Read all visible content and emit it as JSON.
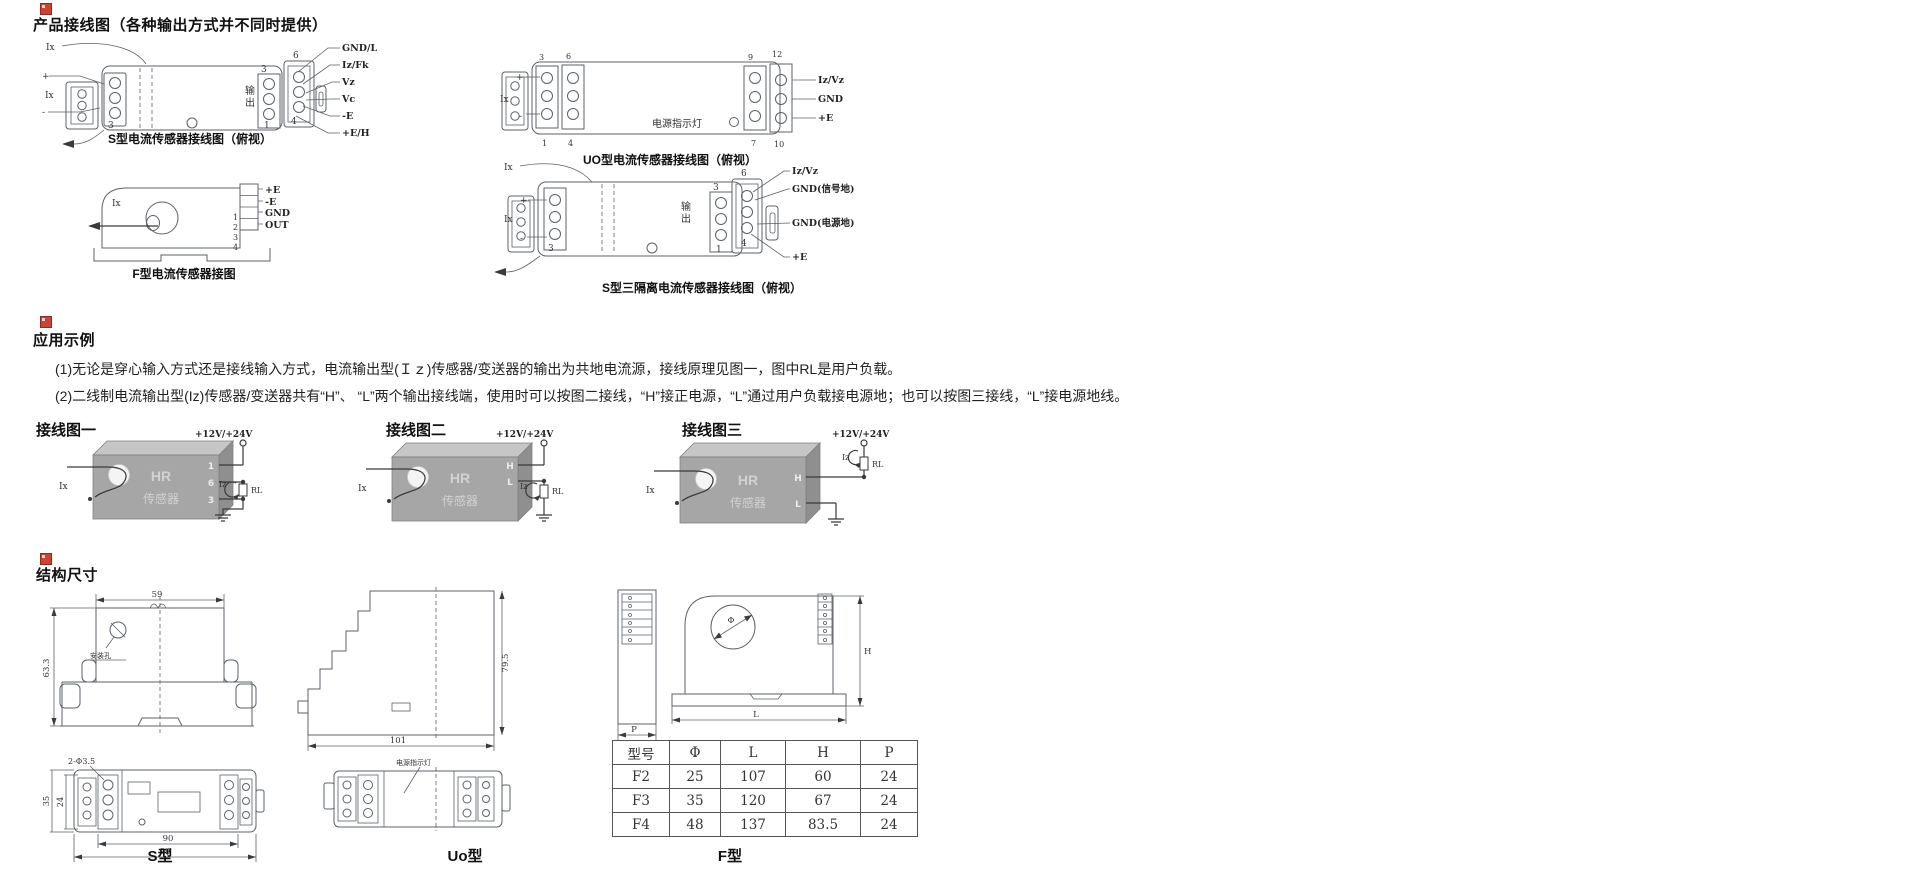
{
  "s1": {
    "title": "产品接线图（各种输出方式并不同时提供）",
    "a": {
      "caption": "S型电流传感器接线图（俯视）",
      "ix1": "Ix",
      "ix2": "Ix",
      "plus": "+",
      "minus": "-",
      "out1": "输",
      "out2": "出",
      "nl3": "3",
      "nr3": "3",
      "nr1": "1",
      "nr6": "6",
      "nr4": "4",
      "labels": [
        "GND/L",
        "Iz/Fk",
        "Vz",
        "Vc",
        "-E",
        "+E/H"
      ]
    },
    "b": {
      "caption": "F型电流传感器接图",
      "ix": "Ix",
      "pins": [
        "+E",
        "-E",
        "GND",
        "OUT"
      ],
      "nums": [
        "1",
        "2",
        "3",
        "4"
      ]
    },
    "c": {
      "caption": "UO型电流传感器接线图（俯视）",
      "ix": "Ix",
      "plus": "+",
      "minus": "-",
      "led": "电源指示灯",
      "n3": "3",
      "n1": "1",
      "n6": "6",
      "n4": "4",
      "n9": "9",
      "n7": "7",
      "n12": "12",
      "n10": "10",
      "labels": [
        "Iz/Vz",
        "GND",
        "+E"
      ]
    },
    "d": {
      "caption": "S型三隔离电流传感器接线图（俯视）",
      "ix1": "Ix",
      "ix2": "Ix",
      "plus": "+",
      "minus": "-",
      "out1": "输",
      "out2": "出",
      "nl3": "3",
      "nr3": "3",
      "nr1": "1",
      "nr6": "6",
      "nr4": "4",
      "labels": [
        "Iz/Vz",
        "GND(信号地)",
        "GND(电源地)",
        "+E"
      ]
    }
  },
  "s2": {
    "title": "应用示例",
    "p1": "(1)无论是穿心输入方式还是接线输入方式，电流输出型(Ｉｚ)传感器/变送器的输出为共地电流源，接线原理见图一，图中RL是用户负载。",
    "p2": "(2)二线制电流输出型(Iz)传感器/变送器共有“H”、 “L”两个输出接线端，使用时可以按图二接线，“H”接正电源，“L”通过用户负载接电源地；也可以按图三接线，“L”接电源地线。",
    "figs": [
      {
        "label": "接线图一",
        "supply": "+12V/+24V",
        "chip_line1": "HR",
        "chip_line2": "传感器",
        "ix": "Ix",
        "iz": "Iz",
        "rl": "RL",
        "t1": "1",
        "t2": "6",
        "t3": "3"
      },
      {
        "label": "接线图二",
        "supply": "+12V/+24V",
        "chip_line1": "HR",
        "chip_line2": "传感器",
        "ix": "Ix",
        "iz": "Iz",
        "rl": "RL",
        "t1": "H",
        "t2": "L"
      },
      {
        "label": "接线图三",
        "supply": "+12V/+24V",
        "chip_line1": "HR",
        "chip_line2": "传感器",
        "ix": "Ix",
        "iz": "Iz",
        "rl": "RL",
        "t1": "H",
        "t2": "L"
      }
    ]
  },
  "s3": {
    "title": "结构尺寸",
    "s": {
      "caption": "S型",
      "dim_top": "59",
      "dim_left": "63.3",
      "hole_label": "安装孔",
      "hole_dim": "2-Φ3.5",
      "dim_w_inner": "24",
      "dim_w_outer": "35",
      "dim_b_inner": "90",
      "dim_b_outer": "99"
    },
    "uo": {
      "caption": "Uo型",
      "dim_bottom": "101",
      "dim_right": "79.5",
      "led": "电源指示灯"
    },
    "f": {
      "caption": "F型",
      "p": "P",
      "phi": "Φ",
      "h": "H",
      "l": "L"
    },
    "table": {
      "headers": [
        "型号",
        "Φ",
        "L",
        "H",
        "P"
      ],
      "rows": [
        [
          "F2",
          "25",
          "107",
          "60",
          "24"
        ],
        [
          "F3",
          "35",
          "120",
          "67",
          "24"
        ],
        [
          "F4",
          "48",
          "137",
          "83.5",
          "24"
        ]
      ]
    }
  }
}
